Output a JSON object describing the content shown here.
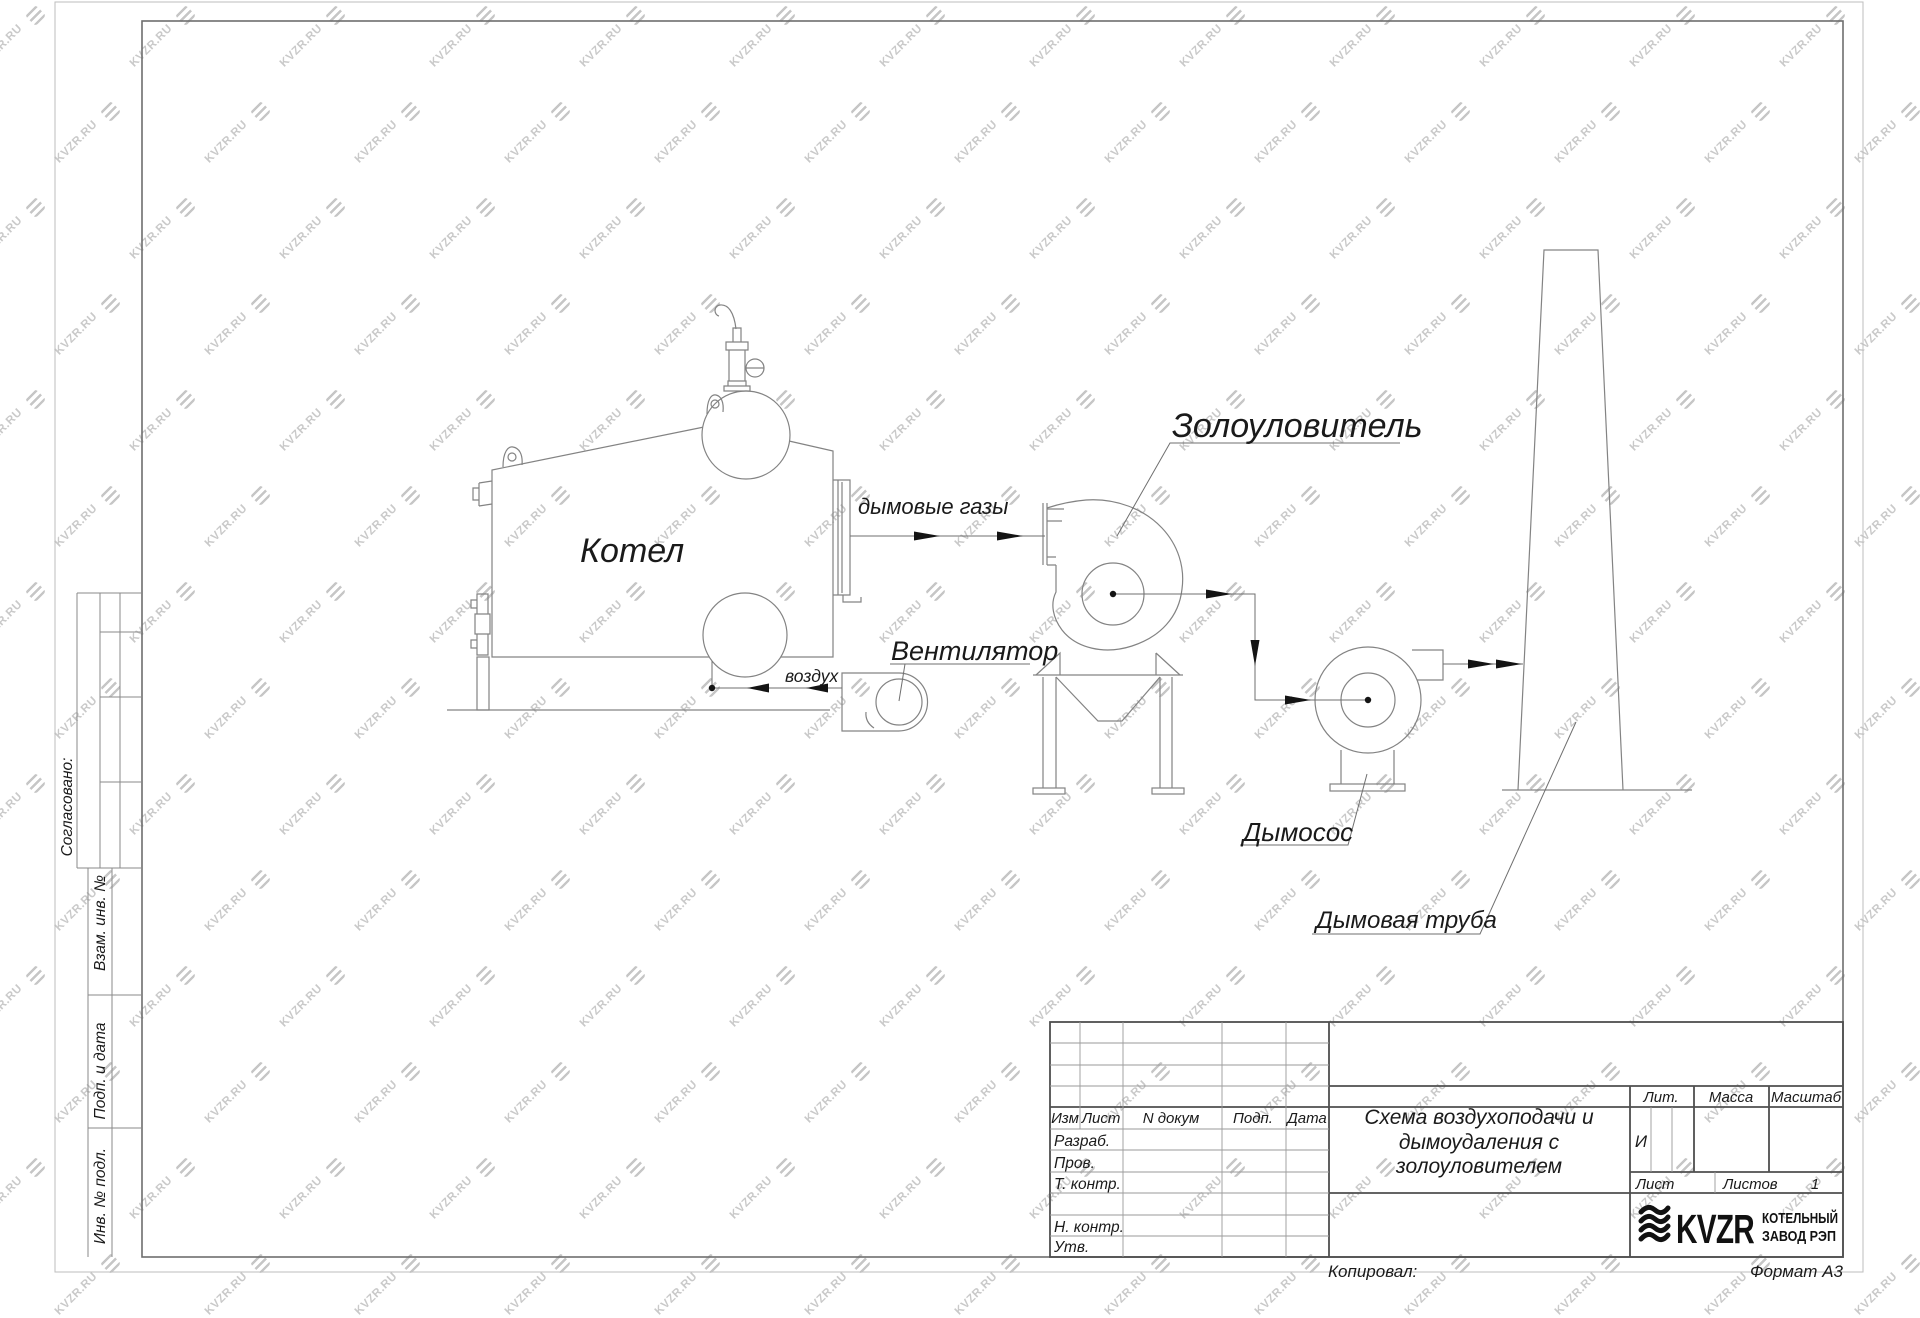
{
  "sheet": {
    "watermark_text": "KVZR.RU",
    "copied_label": "Копировал:",
    "format_label": "Формат А3"
  },
  "colors": {
    "drawing_line": "#838383",
    "text": "#1a1a1a",
    "watermark": "#c9c9c9"
  },
  "schematic": {
    "boiler_label": "Котел",
    "flue_gases_label": "дымовые газы",
    "air_label": "воздух",
    "fan_label": "Вентилятор",
    "ash_catcher_label": "Золоуловитель",
    "smoke_exhauster_label": "Дымосос",
    "chimney_label": "Дымовая труба"
  },
  "margin_labels": {
    "agreed": "Согласовано:",
    "subst_inv": "Взам. инв. №",
    "sign_date": "Подп. и дата",
    "inv_orig": "Инв. № подл."
  },
  "title_block": {
    "columns": {
      "izm": "Изм",
      "list": "Лист",
      "doc": "N докум",
      "sign": "Подп.",
      "date": "Дата"
    },
    "rows": {
      "developed": "Разраб.",
      "checked": "Пров.",
      "tech_control": "Т. контр.",
      "norm_control": "Н. контр.",
      "approved": "Утв."
    },
    "title_line1": "Схема воздухоподачи и",
    "title_line2": "дымоудаления с",
    "title_line3": "золоуловителем",
    "lit_label": "Лит.",
    "mass_label": "Масса",
    "scale_label": "Масштаб",
    "lit_value": "И",
    "sheet_label": "Лист",
    "sheets_label": "Листов",
    "sheets_value": "1",
    "company": {
      "logo_text": "KVZR",
      "name_line1": "КОТЕЛЬНЫЙ",
      "name_line2": "ЗАВОД РЭП"
    }
  }
}
